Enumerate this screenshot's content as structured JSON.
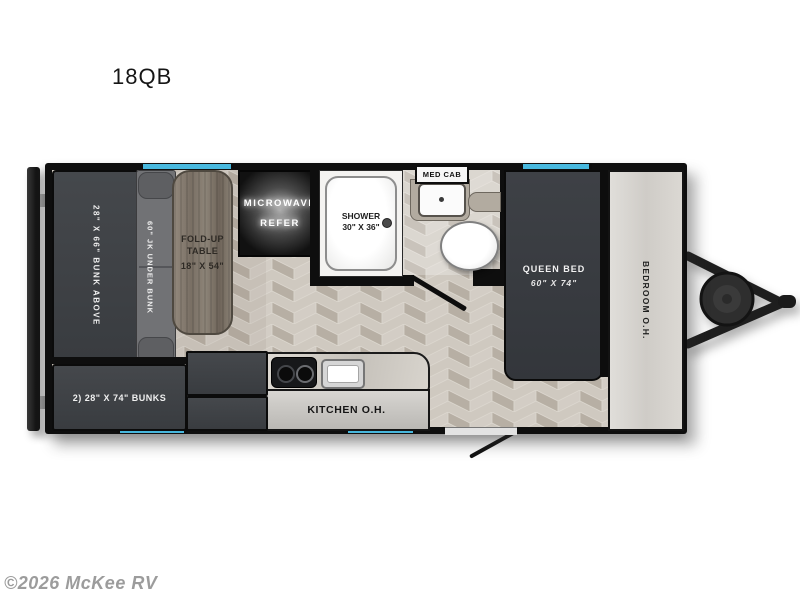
{
  "title": "18QB",
  "watermark": "©2026 McKee RV",
  "colors": {
    "wall": "#0e0e0e",
    "window_accent": "#47b7dd",
    "furniture_dark": "#3d4045",
    "floor_light": "#cfc9c0",
    "floor_dark": "#b5ada2",
    "overhead_panel": "#d8d6d1"
  },
  "floorplan": {
    "front_bunk": {
      "label": "28\" X 66\" BUNK ABOVE"
    },
    "sofa": {
      "label": "60\" JK UNDER BUNK"
    },
    "table": {
      "line1": "FOLD-UP",
      "line2": "TABLE",
      "line3": "18\" X 54\""
    },
    "microwave": {
      "line1": "MICROWAVE",
      "line2": "REFER"
    },
    "shower": {
      "line1": "SHOWER",
      "line2": "30\" X 36\""
    },
    "med_cab": {
      "label": "MED CAB"
    },
    "queen_bed": {
      "line1": "QUEEN BED",
      "line2": "60\" X 74\""
    },
    "bedroom_oh": {
      "label": "BEDROOM O.H."
    },
    "kitchen_oh": {
      "label": "KITCHEN O.H."
    },
    "bunks": {
      "label": "2) 28\" X 74\" BUNKS"
    }
  }
}
